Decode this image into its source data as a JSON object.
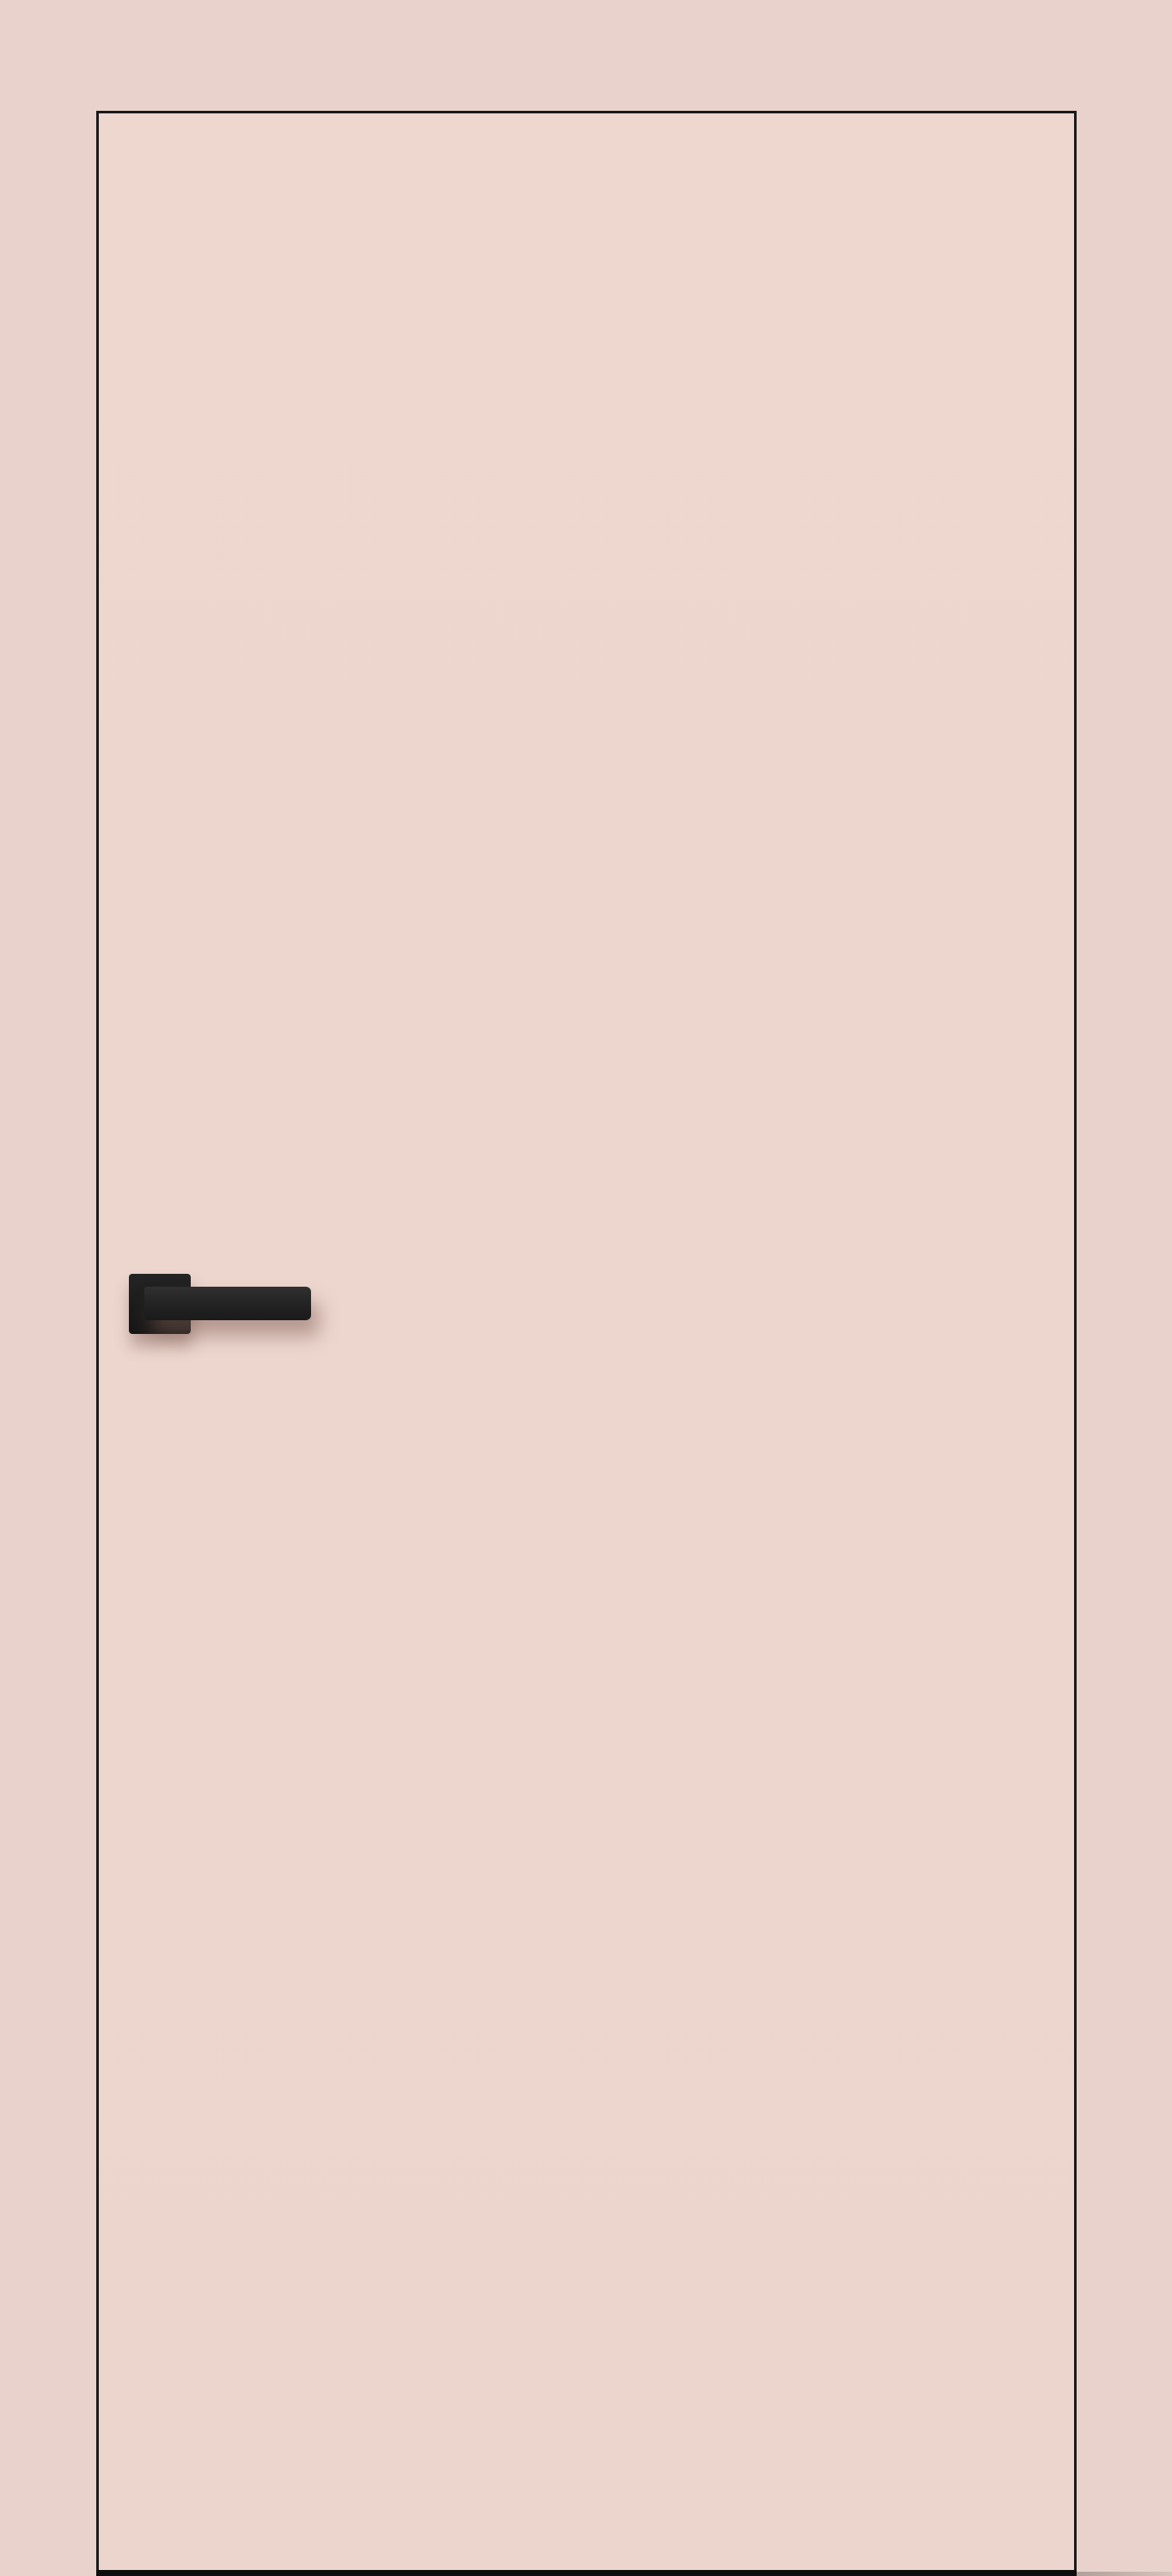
{
  "scene": {
    "subject": "interior flush door leaf with square-rosette lever handle",
    "door_finish": "blush pink, frameless flush leaf with thin dark edge line",
    "handle_style": "matte black square rosette with straight square-profile lever pointing right",
    "text_content": "none visible"
  },
  "colors": {
    "wall_background": "#e8d2cb",
    "door_face": "#ecd6ce",
    "door_edge_line": "#1a1a1a",
    "threshold_bar": "#0d0d0d",
    "handle_black": "#1f1f1f",
    "handle_shadow_warm": "#7d5c52",
    "floor_shadow_gray": "#5a4b46"
  }
}
